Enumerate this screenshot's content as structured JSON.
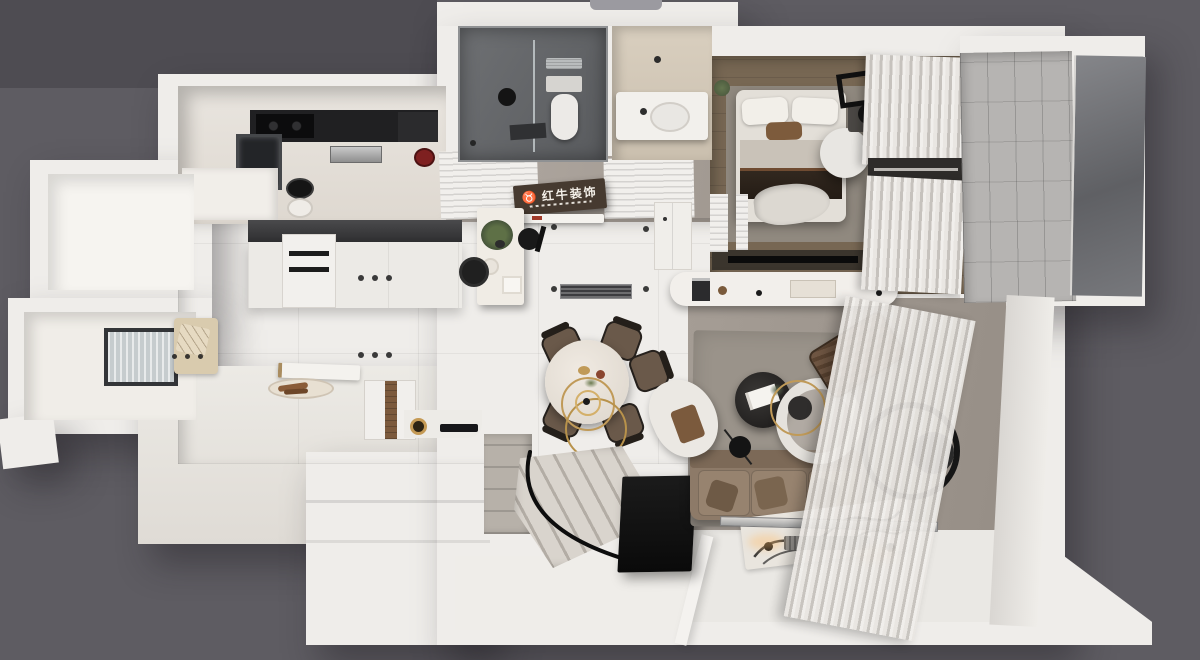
{
  "meta": {
    "description": "Top-down 3D architectural render of a small apartment floor plan"
  },
  "sign": {
    "brand": "红牛装饰",
    "logo_icon": "bull-icon"
  },
  "colors": {
    "bg": "#5e5c62",
    "bgPanel": "#4e4c52",
    "wall": "#efedea",
    "wallShade": "#ddd9d4",
    "floorTile": "#a29a93",
    "floorWood": "#6f5f4d",
    "wetFloor": "#606265",
    "vanityFloor": "#d2c7b5",
    "counterDark": "#333335",
    "sofa": "#8d7a68",
    "cushion": "#97836f",
    "accentChair": "#6e5542",
    "livRug": "#9a938a",
    "bedRug": "#90897f",
    "curtain": "#e9e6e2",
    "curtainRib": "#c6c2bd",
    "balconyTile": "#b6b4b2",
    "glass": "#6c6d71",
    "gold": "#c09a58",
    "signBoard": "#463a30",
    "signText": "#f3efe8",
    "black": "#141414",
    "white": "#f6f4f1",
    "marble": "#f0ece5",
    "steps": "#b6b0a8"
  }
}
